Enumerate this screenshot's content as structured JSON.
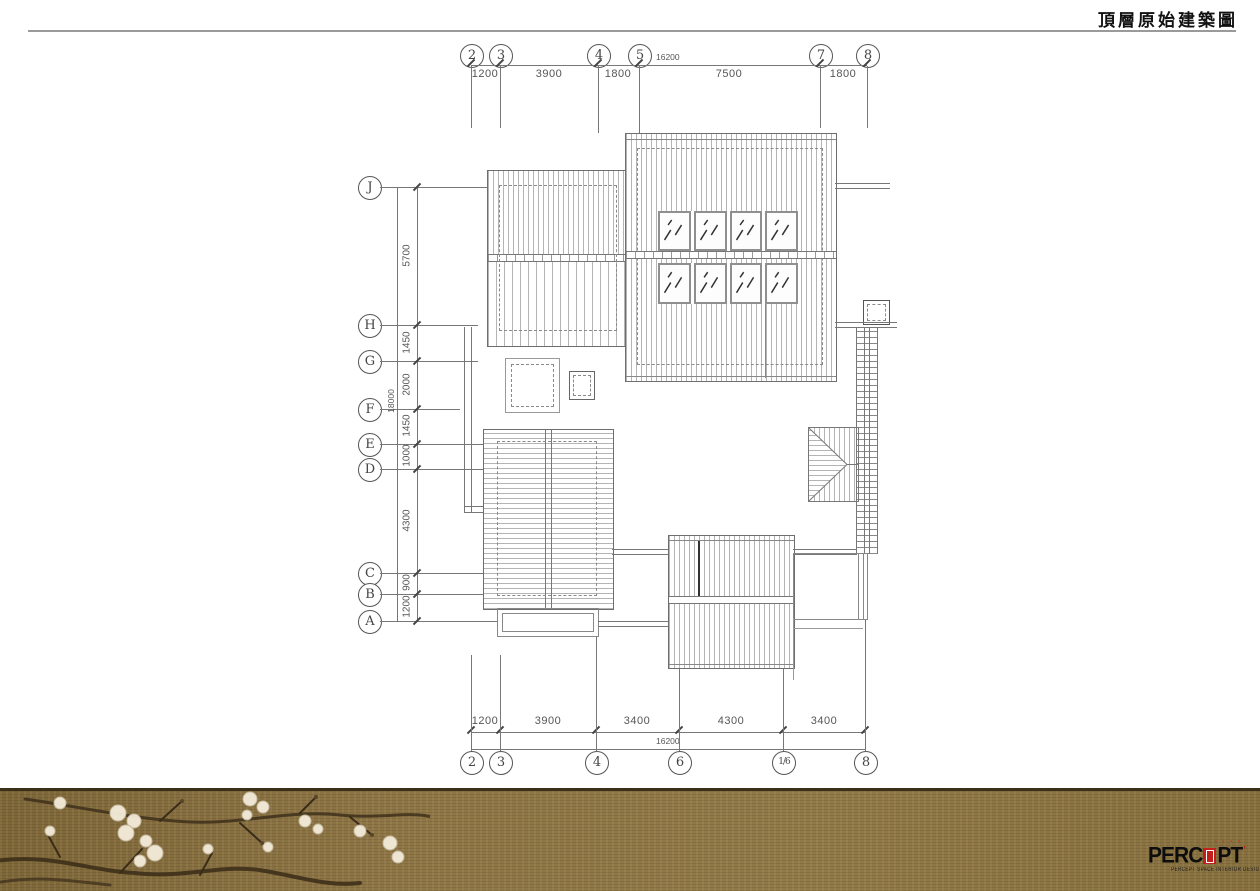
{
  "header": {
    "title": "頂層原始建築圖"
  },
  "axes": {
    "top": {
      "bubbles": [
        "2",
        "3",
        "4",
        "5",
        "7",
        "8"
      ],
      "dims": [
        "1200",
        "3900",
        "1800",
        "7500",
        "1800"
      ],
      "total": "16200"
    },
    "bottom": {
      "bubbles": [
        "2",
        "3",
        "4",
        "6",
        "1/6",
        "8"
      ],
      "dims": [
        "1200",
        "3900",
        "3400",
        "4300",
        "3400"
      ],
      "total": "16200"
    },
    "left": {
      "bubbles": [
        "J",
        "H",
        "G",
        "F",
        "E",
        "D",
        "C",
        "B",
        "A"
      ],
      "dims": [
        "5700",
        "1450",
        "2000",
        "1450",
        "1000",
        "4300",
        "900",
        "1200"
      ],
      "total": "18000"
    }
  },
  "footer": {
    "brand_cjk": "▪ ▪ ▪ ▪",
    "brand_pre": "PERC",
    "brand_post": "PT",
    "brand_tick": "’",
    "brand_caption": "PERCEPT SPACE INTERIOR DESIGN LTD"
  },
  "colors": {
    "accent_red": "#c01f1a",
    "line_gray": "#777777",
    "band_brown": "#8d7546"
  }
}
